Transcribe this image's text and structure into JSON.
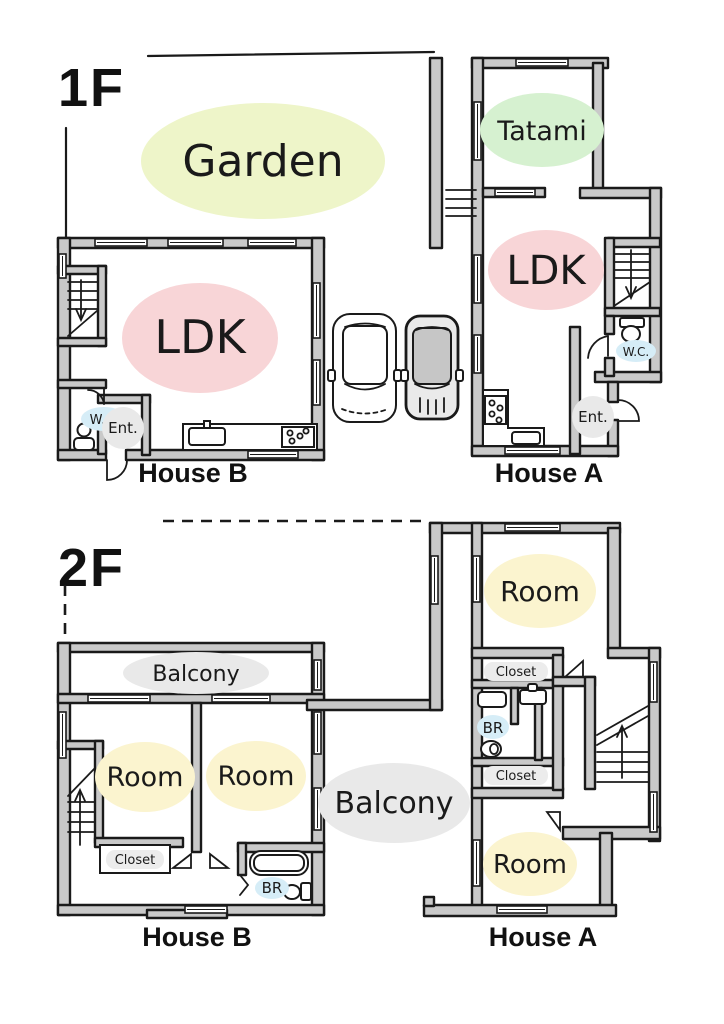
{
  "floor1": {
    "label": "1F",
    "garden": "Garden",
    "house_a": {
      "name": "House A",
      "tatami": "Tatami",
      "ldk": "LDK",
      "wc": "W.C.",
      "ent": "Ent."
    },
    "house_b": {
      "name": "House B",
      "ldk": "LDK",
      "wc": "W.C.",
      "ent": "Ent."
    }
  },
  "floor2": {
    "label": "2F",
    "balcony_center": "Balcony",
    "house_a": {
      "name": "House A",
      "room_top": "Room",
      "room_bottom": "Room",
      "closet_top": "Closet",
      "closet_bottom": "Closet",
      "br": "BR"
    },
    "house_b": {
      "name": "House B",
      "balcony": "Balcony",
      "room_left": "Room",
      "room_right": "Room",
      "closet": "Closet",
      "br": "BR"
    }
  },
  "colors": {
    "garden_highlight": "#eef5c9",
    "tatami_highlight": "#d6f1d0",
    "ldk_highlight": "#f8d5d7",
    "room_highlight": "#fbf4cf",
    "water_highlight": "#d6edf7",
    "zone_highlight": "#e9e9e9",
    "wall_fill": "#c9c9c9",
    "line": "#1a1a1a"
  }
}
